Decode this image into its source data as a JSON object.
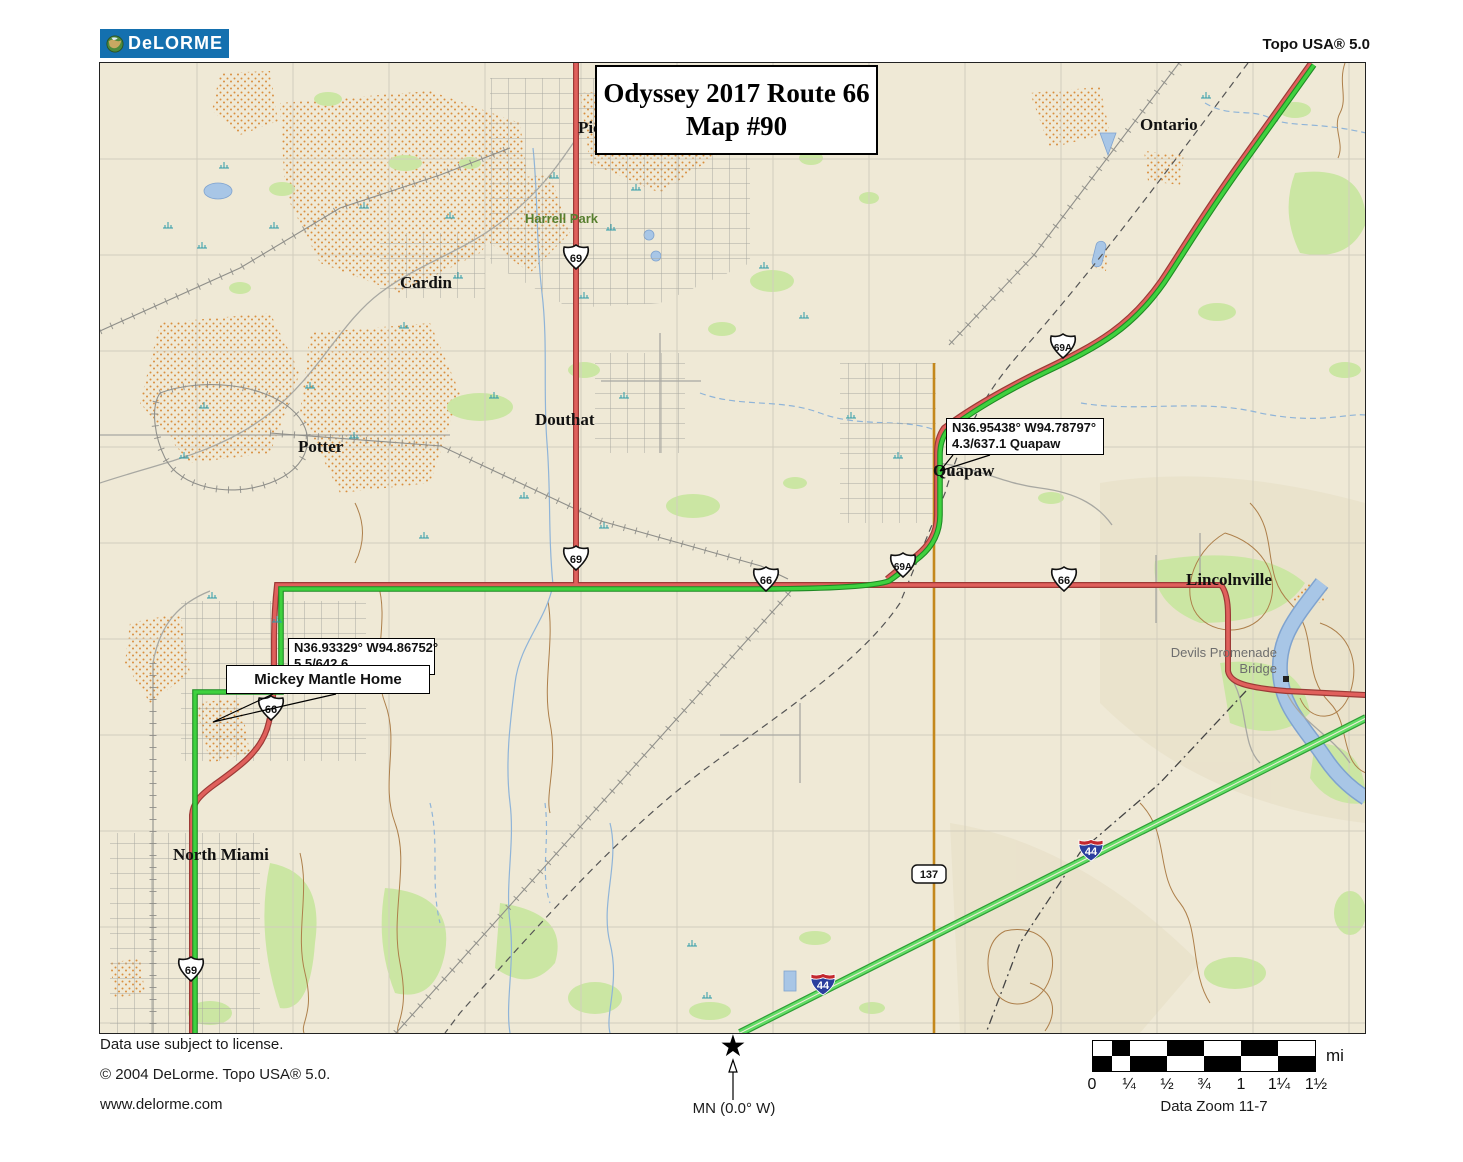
{
  "header": {
    "logo_text": "DeLORME",
    "product_title": "Topo USA® 5.0"
  },
  "map_overlay": {
    "title_line1": "Odyssey 2017 Route 66",
    "title_line2": "Map #90",
    "callout_quapaw": {
      "line1": "N36.95438° W94.78797°",
      "line2": "4.3/637.1 Quapaw"
    },
    "callout_commerce": {
      "line1": "N36.93329° W94.86752°",
      "line2": "5.5/642.6"
    },
    "callout_mickey": {
      "label": "Mickey Mantle Home"
    }
  },
  "labels": {
    "picher_partial": "Pic",
    "cardin": "Cardin",
    "harrell_park": "Harrell Park",
    "douthat": "Douthat",
    "potter": "Potter",
    "quapaw": "Quapaw",
    "ontario": "Ontario",
    "lincolnville": "Lincolnville",
    "commerce": "Commerce",
    "north_miami": "North Miami",
    "bridge_line1": "Devils Promenade",
    "bridge_line2": "Bridge"
  },
  "shields": {
    "us69": "69",
    "us66": "66",
    "us69a": "69A",
    "i44": "44",
    "sr137": "137"
  },
  "footer": {
    "license": "Data use subject to license.",
    "copyright": "© 2004 DeLorme. Topo USA® 5.0.",
    "url": "www.delorme.com",
    "compass_label": "MN (0.0° W)",
    "compass_icon": "north-star",
    "scale_unit": "mi",
    "scale_ticks": [
      "0",
      "¼",
      "½",
      "¾",
      "1",
      "1¼",
      "1½"
    ],
    "data_zoom": "Data Zoom 11-7"
  },
  "colors": {
    "logo_blue": "#1470AF",
    "map_background": "#EFE9D6",
    "highway_red": "#E0605C",
    "route_highlight_green": "#3FD13F",
    "interstate_green": "#62DD66",
    "state_road_orange": "#C4881C",
    "water_blue": "#A8C6E6",
    "stipple_orange": "#D98F3F",
    "vegetation_green": "#CBE6A3",
    "contour_brown": "#AD7F4A"
  }
}
